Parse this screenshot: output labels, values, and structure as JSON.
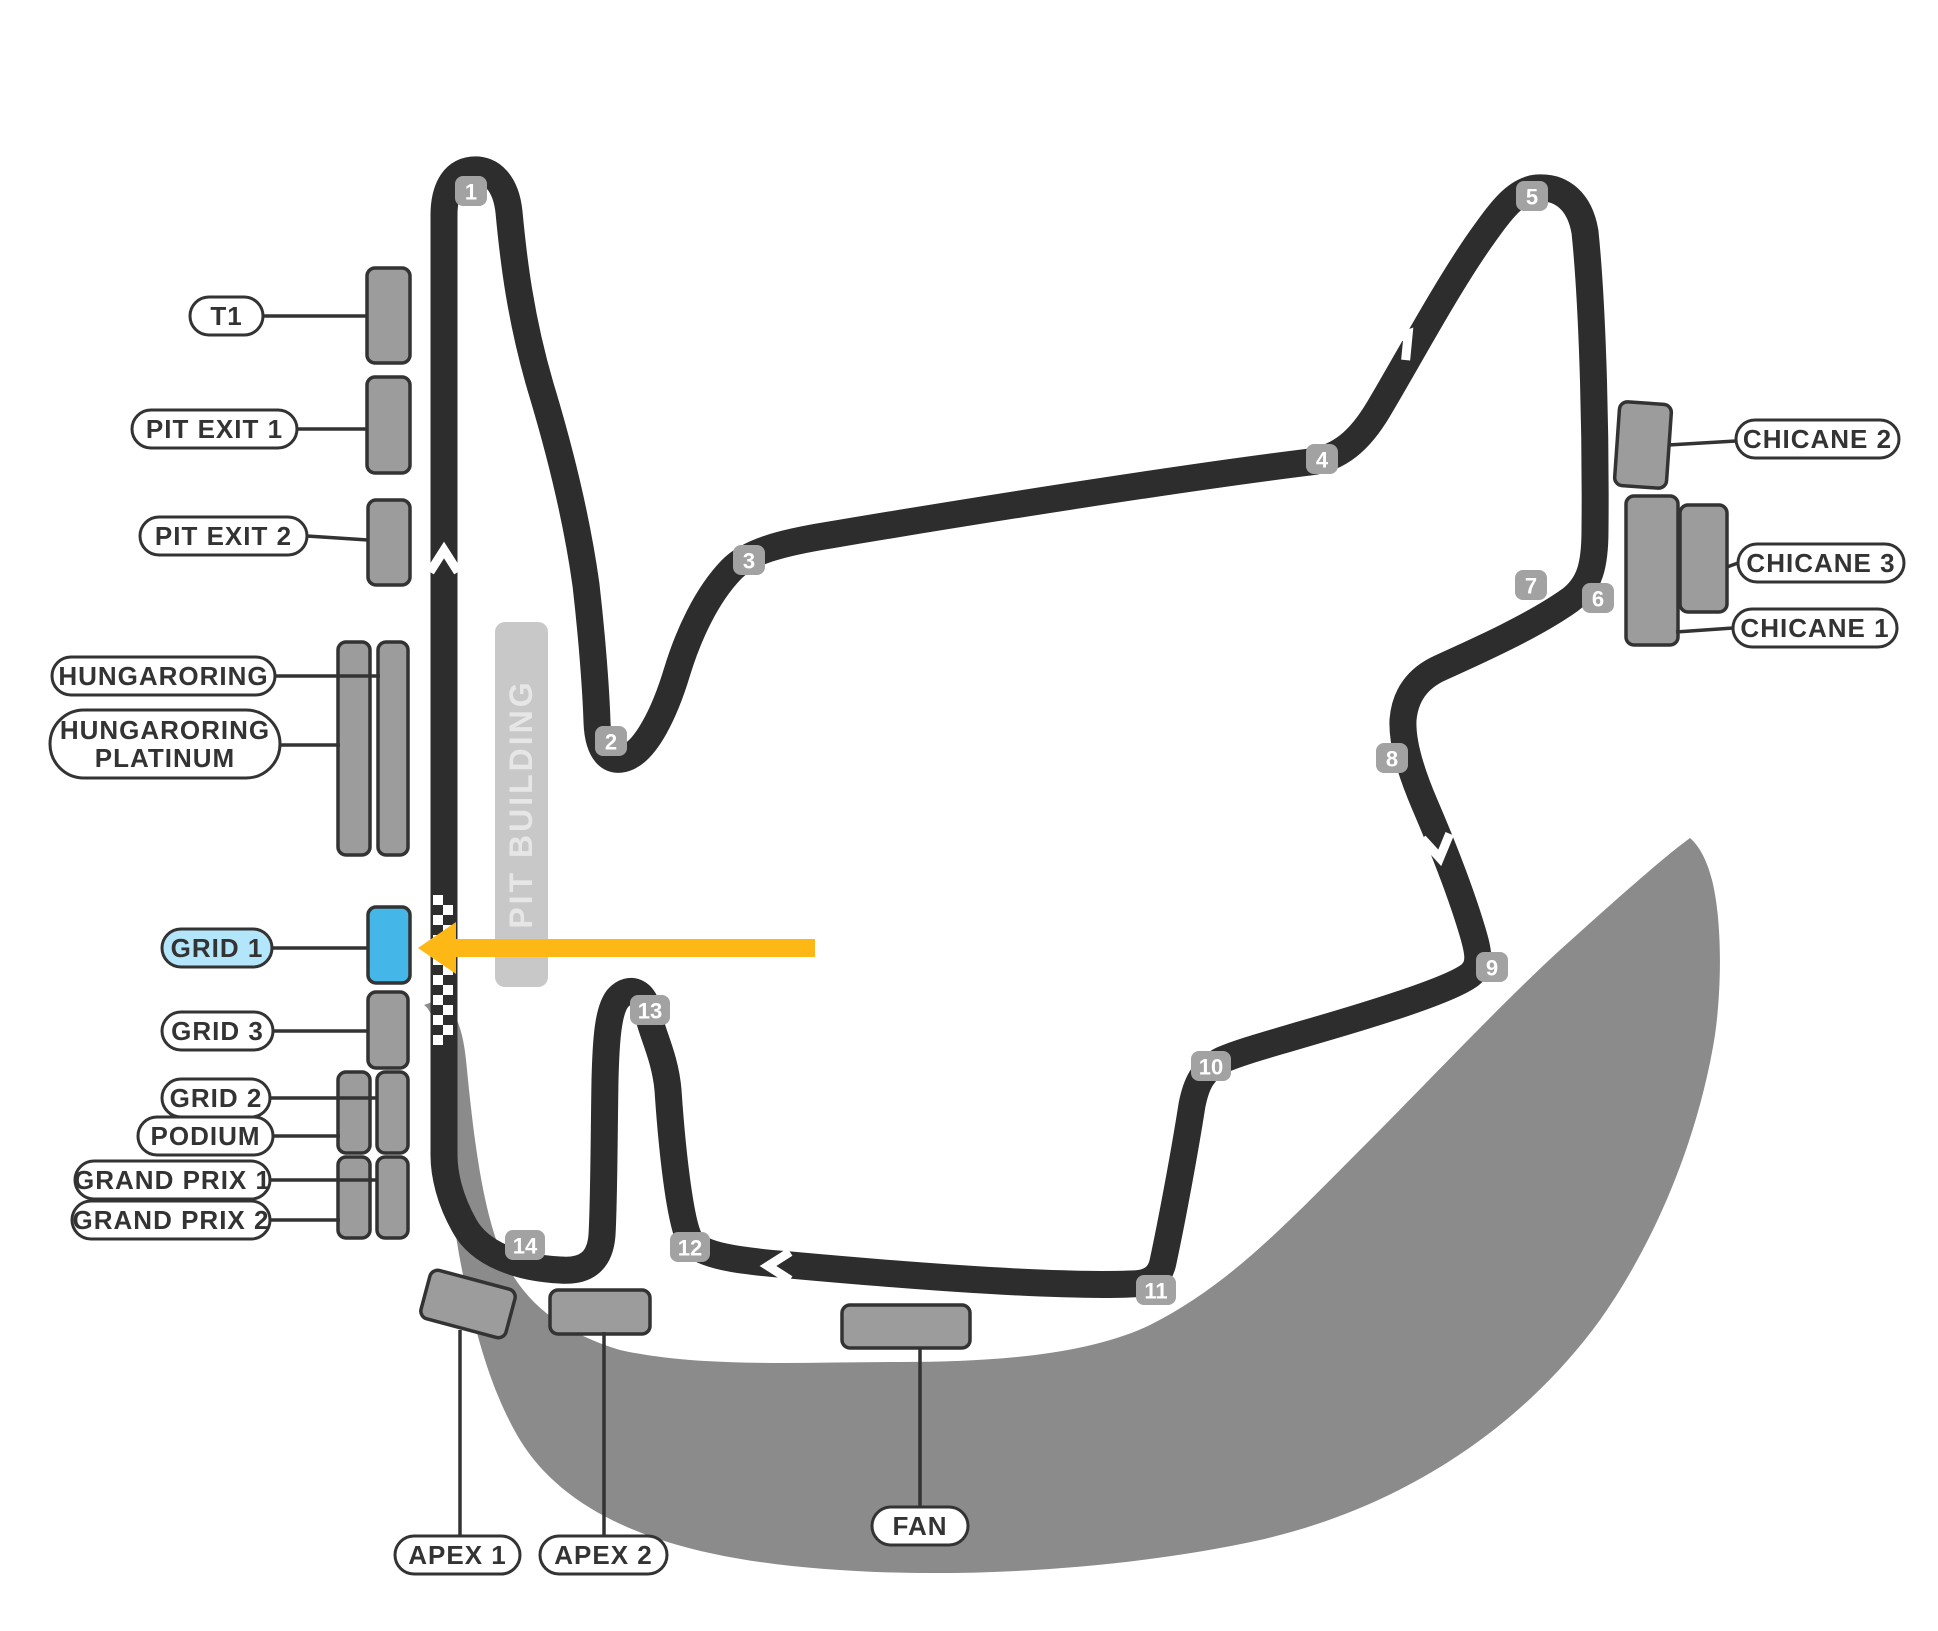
{
  "map": {
    "pit_building_label": "PIT BUILDING",
    "colors": {
      "track": "#2d2d2d",
      "stand_fill": "#9c9c9c",
      "stand_stroke": "#333333",
      "selected_stand_fill": "#45b6e8",
      "selected_pill_fill": "#b3e5fb",
      "pill_fill": "#ffffff",
      "pill_stroke": "#333333",
      "pill_text": "#333333",
      "badge_fill": "#a2a2a2",
      "badge_text": "#ffffff",
      "hill_fill": "#8b8b8b",
      "pit_fill": "#c8c8c8",
      "pit_text": "#e6e6e6",
      "arrow": "#fdb815",
      "leader": "#333333",
      "chevron": "#ffffff"
    },
    "turn_markers": [
      {
        "n": "1",
        "x": 471,
        "y": 191
      },
      {
        "n": "2",
        "x": 611,
        "y": 741
      },
      {
        "n": "3",
        "x": 749,
        "y": 560
      },
      {
        "n": "4",
        "x": 1322,
        "y": 459
      },
      {
        "n": "5",
        "x": 1532,
        "y": 196
      },
      {
        "n": "6",
        "x": 1598,
        "y": 598
      },
      {
        "n": "7",
        "x": 1531,
        "y": 585
      },
      {
        "n": "8",
        "x": 1392,
        "y": 758
      },
      {
        "n": "9",
        "x": 1492,
        "y": 967
      },
      {
        "n": "10",
        "x": 1211,
        "y": 1066
      },
      {
        "n": "11",
        "x": 1156,
        "y": 1290
      },
      {
        "n": "12",
        "x": 690,
        "y": 1247
      },
      {
        "n": "13",
        "x": 650,
        "y": 1010
      },
      {
        "n": "14",
        "x": 525,
        "y": 1245
      }
    ],
    "stands": [
      {
        "id": "t1",
        "x": 367,
        "y": 268,
        "w": 43,
        "h": 95,
        "rot": 0,
        "selected": false
      },
      {
        "id": "pit-exit-1",
        "x": 367,
        "y": 377,
        "w": 43,
        "h": 96,
        "rot": 0,
        "selected": false
      },
      {
        "id": "pit-exit-2",
        "x": 368,
        "y": 500,
        "w": 42,
        "h": 85,
        "rot": 0,
        "selected": false
      },
      {
        "id": "hungaroring-platinum",
        "x": 338,
        "y": 642,
        "w": 32,
        "h": 213,
        "rot": 0,
        "selected": false
      },
      {
        "id": "hungaroring",
        "x": 378,
        "y": 642,
        "w": 30,
        "h": 213,
        "rot": 0,
        "selected": false
      },
      {
        "id": "grid-1",
        "x": 368,
        "y": 907,
        "w": 42,
        "h": 76,
        "rot": 0,
        "selected": true
      },
      {
        "id": "grid-3",
        "x": 368,
        "y": 992,
        "w": 40,
        "h": 76,
        "rot": 0,
        "selected": false
      },
      {
        "id": "podium",
        "x": 338,
        "y": 1072,
        "w": 32,
        "h": 81,
        "rot": 0,
        "selected": false
      },
      {
        "id": "grid-2",
        "x": 377,
        "y": 1072,
        "w": 31,
        "h": 81,
        "rot": 0,
        "selected": false
      },
      {
        "id": "grand-prix-2",
        "x": 338,
        "y": 1157,
        "w": 32,
        "h": 81,
        "rot": 0,
        "selected": false
      },
      {
        "id": "grand-prix-1",
        "x": 377,
        "y": 1157,
        "w": 31,
        "h": 81,
        "rot": 0,
        "selected": false
      },
      {
        "id": "apex-1",
        "x": 424,
        "y": 1279,
        "w": 88,
        "h": 50,
        "rot": 15,
        "selected": false
      },
      {
        "id": "apex-2",
        "x": 550,
        "y": 1290,
        "w": 100,
        "h": 44,
        "rot": 0,
        "selected": false
      },
      {
        "id": "fan",
        "x": 842,
        "y": 1305,
        "w": 128,
        "h": 43,
        "rot": 0,
        "selected": false
      },
      {
        "id": "chicane-2",
        "x": 1617,
        "y": 403,
        "w": 52,
        "h": 84,
        "rot": 4,
        "selected": false
      },
      {
        "id": "chicane-1",
        "x": 1626,
        "y": 496,
        "w": 52,
        "h": 149,
        "rot": 0,
        "selected": false
      },
      {
        "id": "chicane-3",
        "x": 1680,
        "y": 505,
        "w": 47,
        "h": 107,
        "rot": 0,
        "selected": false
      }
    ],
    "labels": [
      {
        "id": "t1",
        "x": 190,
        "y": 297,
        "w": 73,
        "h": 38,
        "lines": [
          "T1"
        ],
        "selected": false
      },
      {
        "id": "pit-exit-1",
        "x": 132,
        "y": 410,
        "w": 165,
        "h": 38,
        "lines": [
          "PIT EXIT 1"
        ],
        "selected": false
      },
      {
        "id": "pit-exit-2",
        "x": 140,
        "y": 517,
        "w": 167,
        "h": 38,
        "lines": [
          "PIT EXIT 2"
        ],
        "selected": false
      },
      {
        "id": "hungaroring",
        "x": 52,
        "y": 657,
        "w": 223,
        "h": 38,
        "lines": [
          "HUNGARORING"
        ],
        "selected": false
      },
      {
        "id": "hungaroring-platinum",
        "x": 50,
        "y": 710,
        "w": 230,
        "h": 68,
        "lines": [
          "HUNGARORING",
          "PLATINUM"
        ],
        "selected": false
      },
      {
        "id": "grid-1",
        "x": 162,
        "y": 929,
        "w": 110,
        "h": 38,
        "lines": [
          "GRID 1"
        ],
        "selected": true
      },
      {
        "id": "grid-3",
        "x": 162,
        "y": 1012,
        "w": 111,
        "h": 38,
        "lines": [
          "GRID 3"
        ],
        "selected": false
      },
      {
        "id": "grid-2",
        "x": 162,
        "y": 1079,
        "w": 108,
        "h": 38,
        "lines": [
          "GRID 2"
        ],
        "selected": false
      },
      {
        "id": "podium",
        "x": 138,
        "y": 1117,
        "w": 135,
        "h": 38,
        "lines": [
          "PODIUM"
        ],
        "selected": false
      },
      {
        "id": "grand-prix-1",
        "x": 75,
        "y": 1161,
        "w": 195,
        "h": 38,
        "lines": [
          "GRAND PRIX 1"
        ],
        "selected": false
      },
      {
        "id": "grand-prix-2",
        "x": 72,
        "y": 1201,
        "w": 198,
        "h": 38,
        "lines": [
          "GRAND PRIX 2"
        ],
        "selected": false
      },
      {
        "id": "chicane-2",
        "x": 1736,
        "y": 420,
        "w": 163,
        "h": 38,
        "lines": [
          "CHICANE 2"
        ],
        "selected": false
      },
      {
        "id": "chicane-3",
        "x": 1738,
        "y": 544,
        "w": 166,
        "h": 38,
        "lines": [
          "CHICANE 3"
        ],
        "selected": false
      },
      {
        "id": "chicane-1",
        "x": 1733,
        "y": 609,
        "w": 164,
        "h": 38,
        "lines": [
          "CHICANE 1"
        ],
        "selected": false
      },
      {
        "id": "apex-1",
        "x": 395,
        "y": 1536,
        "w": 125,
        "h": 38,
        "lines": [
          "APEX 1"
        ],
        "selected": false
      },
      {
        "id": "apex-2",
        "x": 540,
        "y": 1536,
        "w": 127,
        "h": 38,
        "lines": [
          "APEX 2"
        ],
        "selected": false
      },
      {
        "id": "fan",
        "x": 872,
        "y": 1507,
        "w": 96,
        "h": 38,
        "lines": [
          "FAN"
        ],
        "selected": false
      }
    ],
    "leader_lines": [
      {
        "id": "t1",
        "x1": 263,
        "y1": 316,
        "x2": 367,
        "y2": 316
      },
      {
        "id": "pit-exit-1",
        "x1": 297,
        "y1": 429,
        "x2": 367,
        "y2": 429
      },
      {
        "id": "pit-exit-2",
        "x1": 307,
        "y1": 536,
        "x2": 368,
        "y2": 540
      },
      {
        "id": "hungaroring",
        "x1": 275,
        "y1": 676,
        "x2": 380,
        "y2": 676
      },
      {
        "id": "hungaroring-platinum",
        "x1": 280,
        "y1": 745,
        "x2": 340,
        "y2": 745
      },
      {
        "id": "grid-1",
        "x1": 272,
        "y1": 948,
        "x2": 368,
        "y2": 948
      },
      {
        "id": "grid-3",
        "x1": 273,
        "y1": 1031,
        "x2": 368,
        "y2": 1031
      },
      {
        "id": "grid-2",
        "x1": 270,
        "y1": 1098,
        "x2": 378,
        "y2": 1098
      },
      {
        "id": "podium",
        "x1": 273,
        "y1": 1136,
        "x2": 340,
        "y2": 1136
      },
      {
        "id": "grand-prix-1",
        "x1": 270,
        "y1": 1180,
        "x2": 378,
        "y2": 1180
      },
      {
        "id": "grand-prix-2",
        "x1": 270,
        "y1": 1220,
        "x2": 340,
        "y2": 1220
      },
      {
        "id": "chicane-2",
        "x1": 1736,
        "y1": 441,
        "x2": 1668,
        "y2": 445
      },
      {
        "id": "chicane-3",
        "x1": 1738,
        "y1": 563,
        "x2": 1727,
        "y2": 567
      },
      {
        "id": "chicane-1",
        "x1": 1733,
        "y1": 628,
        "x2": 1676,
        "y2": 632
      },
      {
        "id": "apex-1",
        "x1": 460,
        "y1": 1536,
        "x2": 460,
        "y2": 1330
      },
      {
        "id": "apex-2",
        "x1": 604,
        "y1": 1536,
        "x2": 604,
        "y2": 1332
      },
      {
        "id": "fan",
        "x1": 920,
        "y1": 1507,
        "x2": 920,
        "y2": 1347
      }
    ],
    "direction_chevrons": [
      {
        "x": 444,
        "y": 560,
        "r": 0
      },
      {
        "x": 722,
        "y": 646,
        "r": 40
      },
      {
        "x": 1402,
        "y": 342,
        "r": 38
      },
      {
        "x": 1438,
        "y": 848,
        "r": 170
      },
      {
        "x": 778,
        "y": 1266,
        "r": -90
      }
    ],
    "selected_arrow": {
      "tip_x": 418,
      "tip_y": 948,
      "tail_x": 815
    }
  }
}
